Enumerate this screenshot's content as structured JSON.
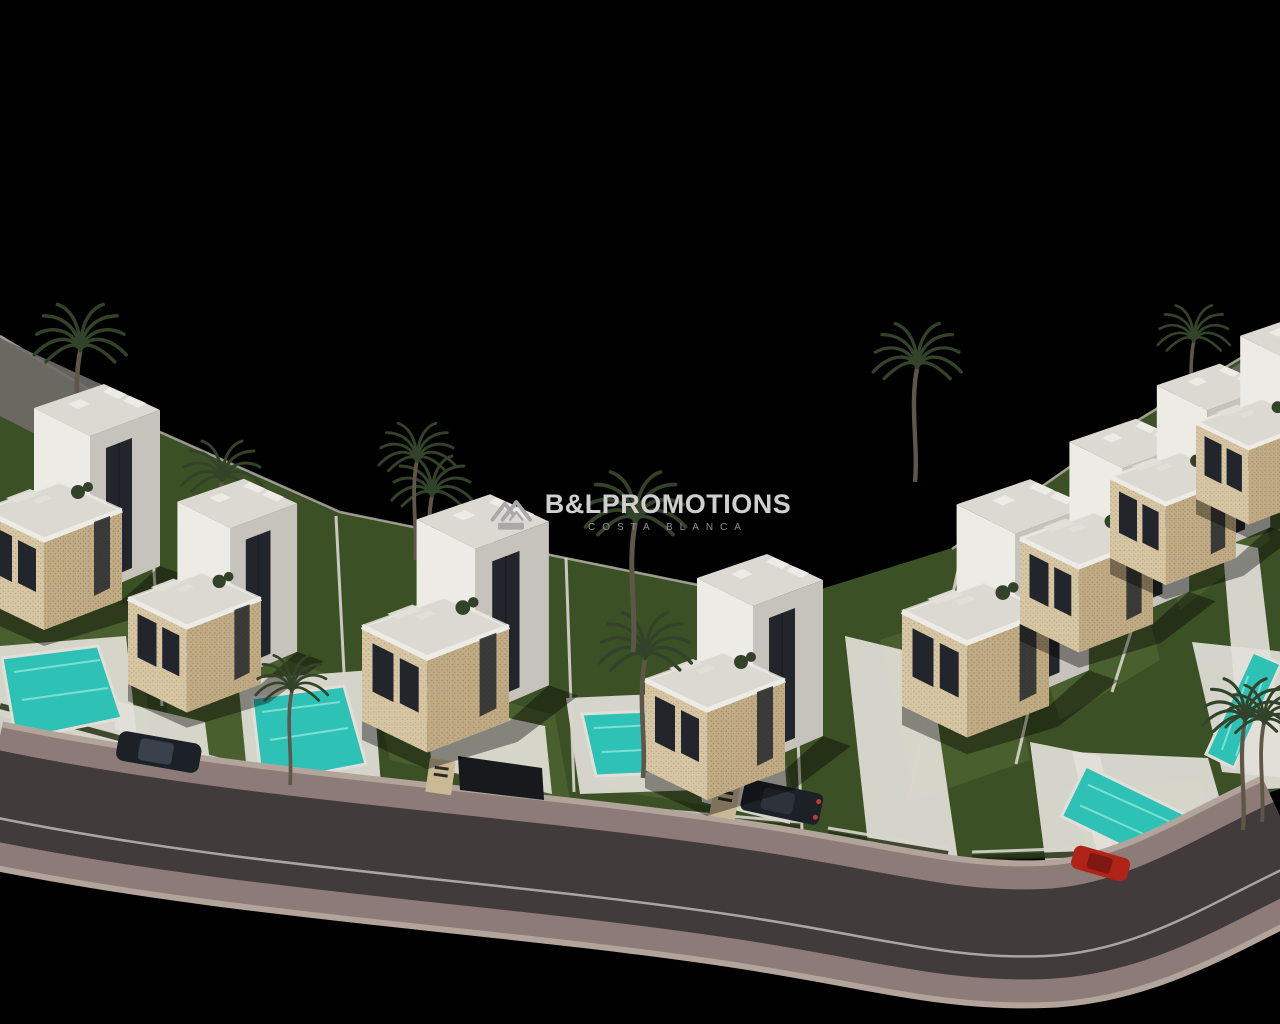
{
  "watermark": {
    "brand_bold": "B&L",
    "brand_rest": "PROMOTIONS",
    "subtitle": "COSTA BLANCA",
    "icon": "twin-house-logo"
  },
  "scene": {
    "description": "Aerial 3D night render of a modern white-villa development with private pools, lawns and palm trees along an S-curved road, on a black background",
    "background": "black",
    "counts": {
      "villas": 8,
      "pools": 5,
      "palm_trees": 11,
      "cars": 3,
      "entrance_signs": 2
    },
    "cars": {
      "dark_cars": 2,
      "red_cars": 1
    },
    "colors": {
      "villa_white": "#ecebe5",
      "villa_shade": "#c6c3bd",
      "roof_gray": "#dcd9d3",
      "stone_beige": "#d6c6a4",
      "stone_shade": "#c0ab84",
      "window_dark": "#22262c",
      "lawn_base": "#3c5026",
      "lawn_patch": "#4a6130",
      "hedge_green": "#243016",
      "pool_teal": "#2ec2b6",
      "pool_ripple": "#8fe6db",
      "deck_white": "#e2dfd8",
      "wall_white": "#d9d5cd",
      "ramp_gray": "#6f6c68",
      "asphalt": "#413b3c",
      "sidewalk": "#8d7b77",
      "curb": "#b3a49b",
      "lane_line": "#cfcac4",
      "palm_frond": "#33432a",
      "palm_trunk": "#5e5648",
      "car_dark": "#1c2127",
      "car_red": "#b02418",
      "sign_beige": "#cbb895",
      "wm_text": "#cfcfcf",
      "wm_sub": "#8f8f8f",
      "wm_icon": "#a9a9a9"
    }
  }
}
